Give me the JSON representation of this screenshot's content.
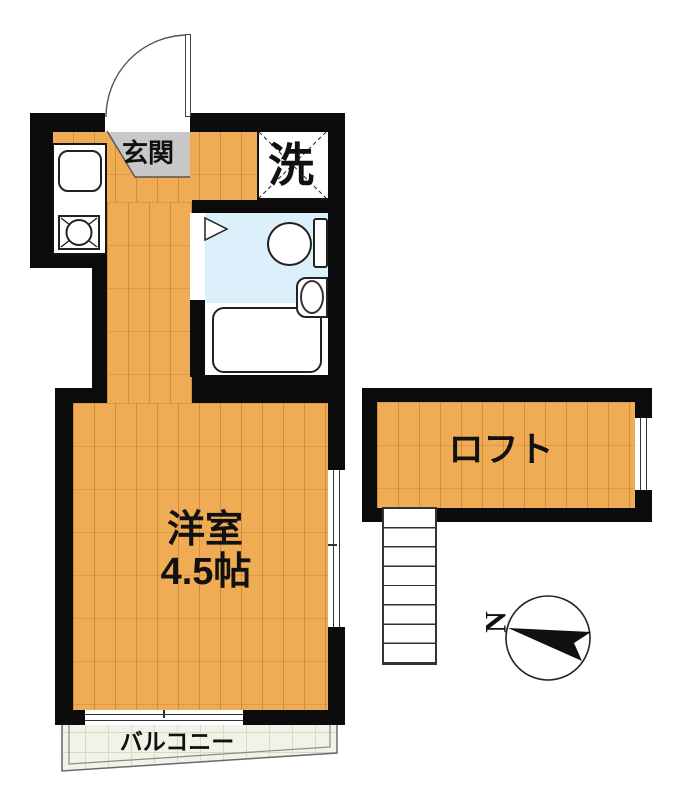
{
  "plan": {
    "type": "apartment-floor-plan",
    "rooms": {
      "entrance": {
        "label": "玄関"
      },
      "laundry": {
        "label": "洗"
      },
      "main_room": {
        "label_line1": "洋室",
        "label_line2": "4.5帖",
        "size_tatami": 4.5
      },
      "loft": {
        "label": "ロフト"
      },
      "balcony": {
        "label": "バルコニー"
      }
    },
    "fixtures": [
      "kitchen-sink",
      "gas-stove",
      "washing-machine-space",
      "toilet",
      "washbasin",
      "bathtub",
      "entrance-door",
      "stairs-to-loft"
    ],
    "compass": {
      "north_label": "N",
      "north_direction": "left"
    },
    "colors": {
      "wall": "#0b0b0b",
      "wood_floor": "#EFAC54",
      "wood_floor_line": "#D1913E",
      "entrance_gray": "#C8C8C8",
      "bathroom_blue": "#DBF0FA",
      "balcony_fill": "#F2F2E8",
      "balcony_grid": "#D9D9C8"
    }
  }
}
